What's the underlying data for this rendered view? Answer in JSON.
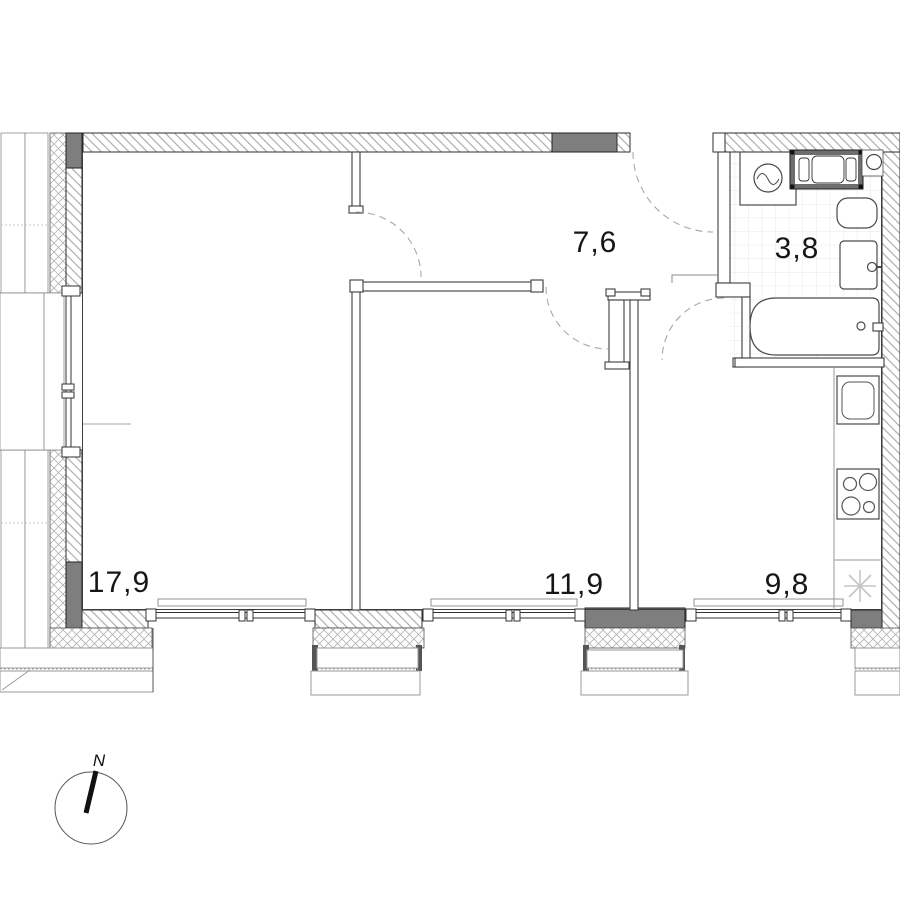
{
  "plan": {
    "rooms": [
      {
        "name": "living-room",
        "area_label": "17,9"
      },
      {
        "name": "hallway",
        "area_label": "7,6"
      },
      {
        "name": "bathroom",
        "area_label": "3,8"
      },
      {
        "name": "bedroom",
        "area_label": "11,9"
      },
      {
        "name": "kitchen",
        "area_label": "9,8"
      }
    ],
    "compass": {
      "label": "N"
    },
    "symbols": {
      "fridge": "snowflake-asterisk",
      "washing_machine": "drum-circle",
      "stove": "four-burners",
      "bath": "tub-with-drain"
    },
    "colors": {
      "wall_dark": "#7e7e7e",
      "line": "#2e2e2e",
      "hatch": "#9d9d9d",
      "crosshatch": "#b3b3b3",
      "tile_grid": "#e7e7e7",
      "door_arc": "#a8a8a8",
      "snowflake": "#c6c6c6"
    }
  }
}
